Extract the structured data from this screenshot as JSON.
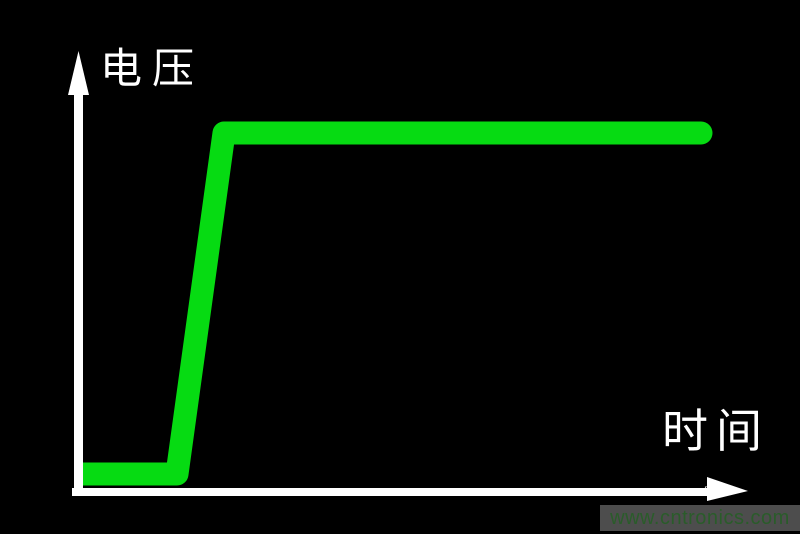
{
  "figure": {
    "y_axis_label": "电压",
    "x_axis_label": "时间",
    "x_axis_label_small": "时间",
    "background_color": "#000000",
    "axis_color": "#ffffff"
  },
  "watermark": {
    "url": "www.cntronics.com",
    "bar_color": "#4d4d4d",
    "text_color": "#2a5c2a"
  },
  "chart_data": {
    "type": "line",
    "title": "",
    "xlabel": "时间",
    "ylabel": "电压",
    "x_ticks": [],
    "y_ticks": [],
    "grid": false,
    "legend": false,
    "description": "Schematic step voltage waveform: flat low level near zero, fast linear ramp up, then constant high level versus time.",
    "series": [
      {
        "name": "电压",
        "color": "#06db12",
        "stroke_width_px": 23,
        "points_normalized": [
          [
            0.0,
            0.04
          ],
          [
            0.15,
            0.04
          ],
          [
            0.23,
            0.82
          ],
          [
            0.99,
            0.82
          ]
        ],
        "polyline_px": [
          [
            82,
            474
          ],
          [
            177,
            474
          ],
          [
            224,
            133
          ],
          [
            701,
            133
          ]
        ]
      }
    ]
  }
}
